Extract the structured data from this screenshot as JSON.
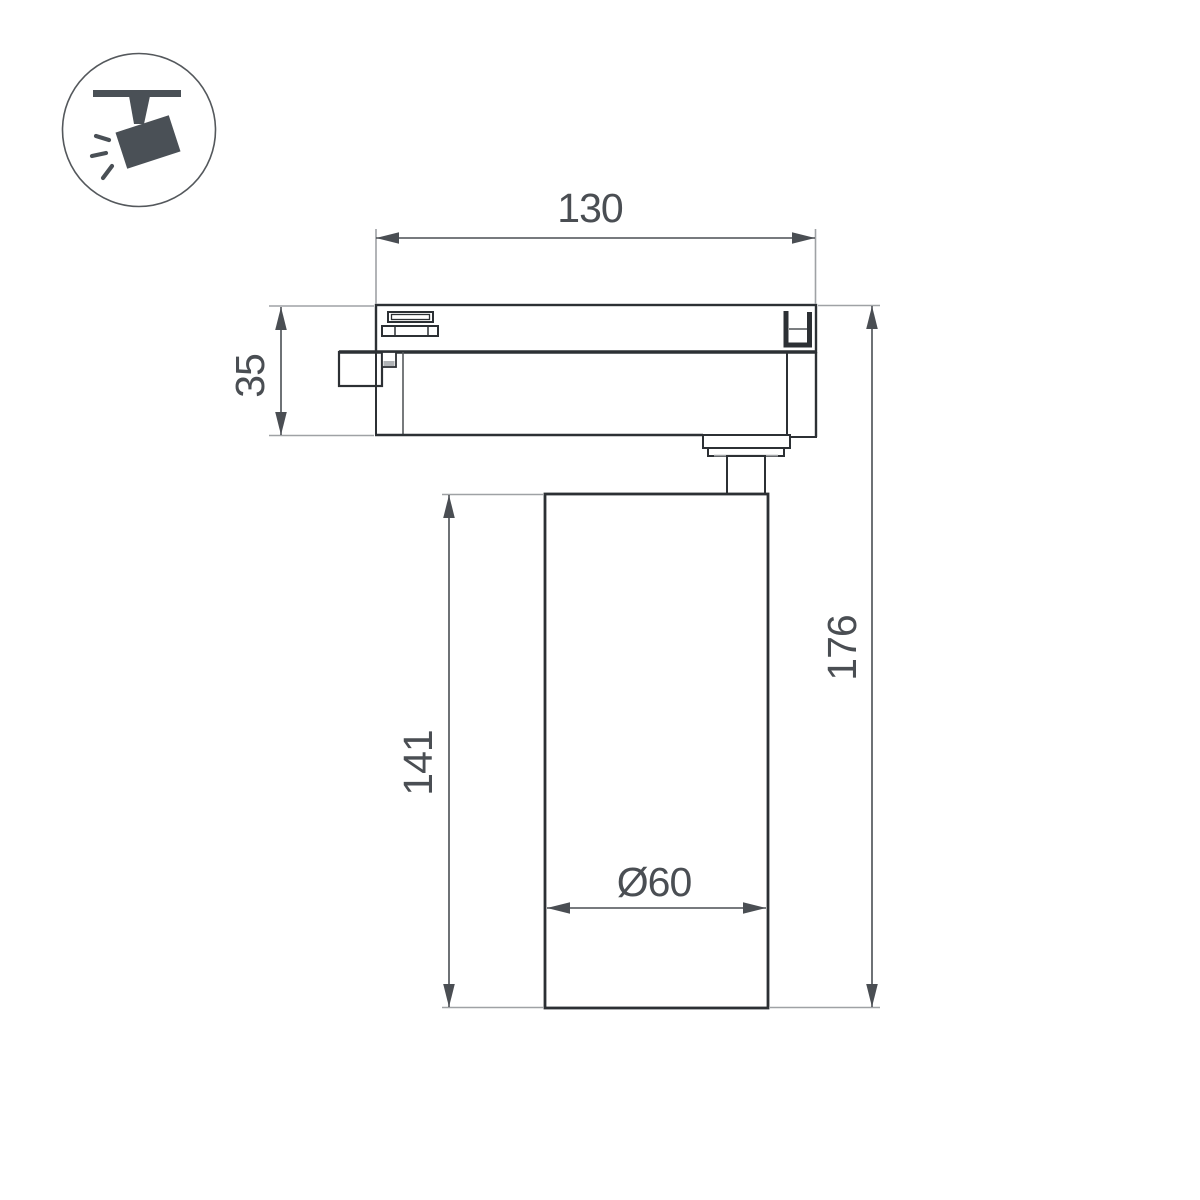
{
  "page": {
    "background": "#ffffff",
    "type": "technical-dimension-drawing"
  },
  "icon": {
    "name": "ceiling-track-spotlight-pictogram"
  },
  "drawing": {
    "dimensions": {
      "width": "130",
      "adapter_height": "35",
      "body_height": "141",
      "total_height": "176",
      "diameter": "Ø60"
    }
  },
  "colors": {
    "outline": "#2c3034",
    "dimension_lines": "#4a4e53",
    "extension_lines": "#9fa2a5",
    "icon_fill": "#4a5056",
    "detail_gray": "#b0b3b6"
  }
}
